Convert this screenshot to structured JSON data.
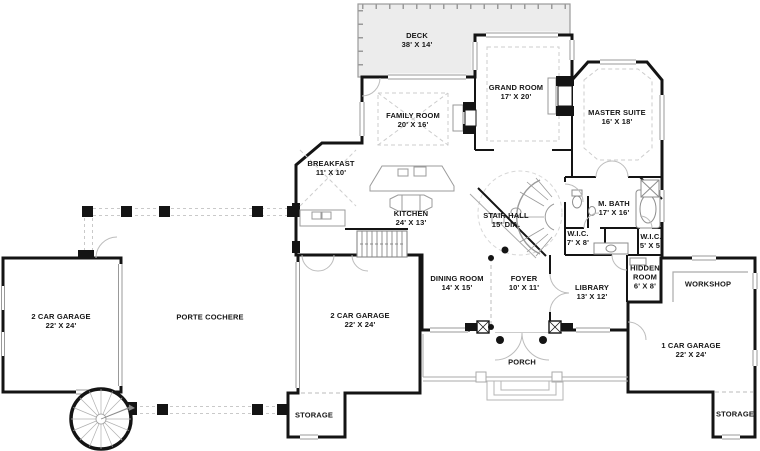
{
  "plan": {
    "title": "First floor plan",
    "colors": {
      "wall": "#141414",
      "deck_fill": "#ececec",
      "light_line": "#aaaaaa",
      "dashed_line": "#c9c9c9",
      "text": "#161616"
    },
    "rooms": [
      {
        "id": "deck",
        "name": "DECK",
        "dims": "38' X 14'"
      },
      {
        "id": "family-room",
        "name": "FAMILY ROOM",
        "dims": "20' X 16'"
      },
      {
        "id": "grand-room",
        "name": "GRAND ROOM",
        "dims": "17' X 20'"
      },
      {
        "id": "master-suite",
        "name": "MASTER SUITE",
        "dims": "16' X 18'"
      },
      {
        "id": "breakfast",
        "name": "BREAKFAST",
        "dims": "11' X 10'"
      },
      {
        "id": "kitchen",
        "name": "KITCHEN",
        "dims": "24' X 13'"
      },
      {
        "id": "stair-hall",
        "name": "STAIR HALL",
        "dims": "15' DIA."
      },
      {
        "id": "m-bath",
        "name": "M. BATH",
        "dims": "17' X 16'"
      },
      {
        "id": "wic-1",
        "name": "W.I.C.",
        "dims": "7' X 8'"
      },
      {
        "id": "wic-2",
        "name": "W.I.C.",
        "dims": "5' X 5'"
      },
      {
        "id": "dining-room",
        "name": "DINING ROOM",
        "dims": "14' X 15'"
      },
      {
        "id": "foyer",
        "name": "FOYER",
        "dims": "10' X 11'"
      },
      {
        "id": "library",
        "name": "LIBRARY",
        "dims": "13' X 12'"
      },
      {
        "id": "hidden-room",
        "name": "HIDDEN ROOM",
        "dims": "6' X 8'"
      },
      {
        "id": "porch",
        "name": "PORCH",
        "dims": ""
      },
      {
        "id": "garage-left",
        "name": "2 CAR GARAGE",
        "dims": "22' X 24'"
      },
      {
        "id": "porte-cochere",
        "name": "PORTE COCHERE",
        "dims": ""
      },
      {
        "id": "garage-middle",
        "name": "2 CAR GARAGE",
        "dims": "22' X 24'"
      },
      {
        "id": "storage-middle",
        "name": "STORAGE",
        "dims": ""
      },
      {
        "id": "workshop",
        "name": "WORKSHOP",
        "dims": ""
      },
      {
        "id": "garage-right",
        "name": "1 CAR GARAGE",
        "dims": "22' X 24'"
      },
      {
        "id": "storage-right",
        "name": "STORAGE",
        "dims": ""
      }
    ],
    "symbols": [
      "spiral-staircase",
      "curved-staircase",
      "straight-staircase",
      "fireplace",
      "double-entry-doors",
      "porch-steps",
      "bathtub",
      "toilet",
      "kitchen-island",
      "porte-cochere-columns",
      "garage-doors"
    ]
  }
}
